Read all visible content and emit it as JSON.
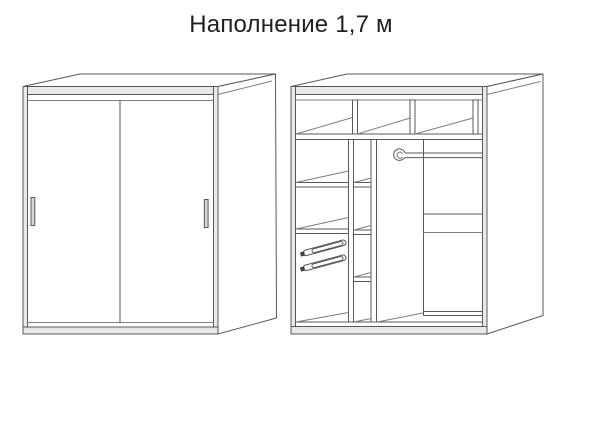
{
  "title": "Наполнение 1,7 м",
  "colors": {
    "background": "#ffffff",
    "line": "#585858",
    "line_light": "#7d7d7d",
    "band_fill": "#e9e9e9",
    "handle_fill": "#d6d6d6",
    "bracket_dark": "#3f3f3f",
    "panel_fill": "#ffffff",
    "text": "#1f1f1f"
  },
  "components": {
    "closed_view": [
      "sliding-door-left",
      "sliding-door-right",
      "door-handle-left",
      "door-handle-right"
    ],
    "interior_view": [
      "top-shelf-row",
      "shelf-dividers",
      "left-shelf-column",
      "middle-shelf-column",
      "drawer-slides",
      "hanging-rod",
      "rod-bracket",
      "bottom-shoe-shelf"
    ]
  }
}
